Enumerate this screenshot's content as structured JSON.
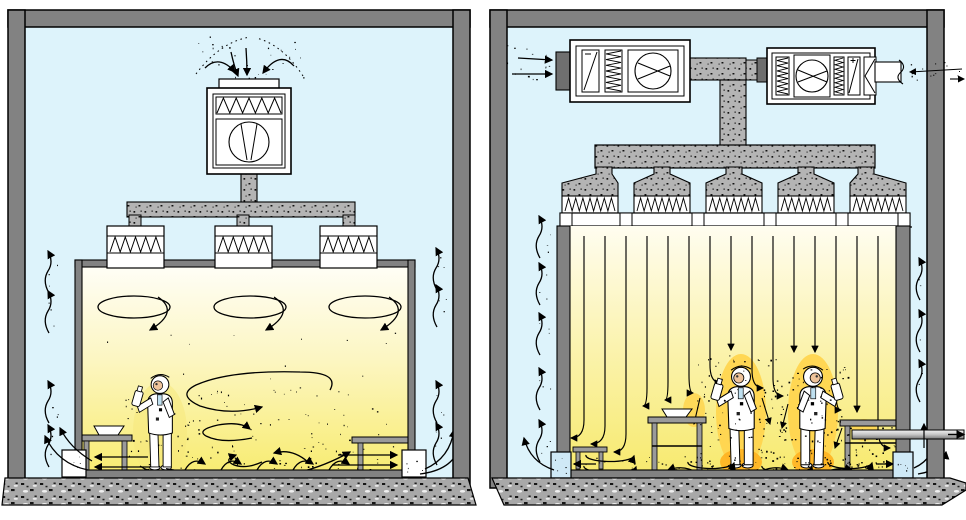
{
  "colors": {
    "background": "#ffffff",
    "wall_gray": "#828282",
    "collar_gray": "#6f6f6f",
    "ambient_blue": "#ddf3fb",
    "duct_stipple_gray": "#b4b4b4",
    "concrete_gray": "#a8a8a8",
    "room_left_top": "#fffef6",
    "room_left_mid": "#fcf6c2",
    "room_left_bottom": "#f8ec72",
    "room_right_top": "#fffdf0",
    "room_right_mid": "#fbf3ae",
    "room_right_bottom": "#f7ea70",
    "contamination_glow": "#ffd54f",
    "contamination_deep": "#ffb320",
    "dust_cloud": "#f6e87b",
    "grille_blue": "#cfe9f6",
    "grille_white": "#ffffff",
    "bench_gray": "#9a9a9a",
    "suit_white": "#ffffff",
    "skin_tone": "#eec39a",
    "accent_lightblue": "#bfe0f0",
    "line_black": "#000000"
  },
  "left_panel": {
    "type": "turbulent-flow-cleanroom",
    "air_handler_units": 1,
    "ceiling_filters": 3,
    "ceiling_eddies": 3,
    "workers": 1,
    "benches": 2,
    "return_grilles": 2,
    "rise_arrows_left": 4,
    "rise_arrows_right": 4,
    "floor_hop_arrows": 5,
    "intake_arrows": 4
  },
  "right_panel": {
    "type": "unidirectional-flow-cleanroom",
    "air_handler_units": 2,
    "ceiling_filters": 5,
    "streamlines": 15,
    "workers": 2,
    "tables": 3,
    "return_grilles": 2,
    "rise_arrows_left": 5,
    "rise_arrows_right": 3,
    "intake_arrows": 2
  }
}
